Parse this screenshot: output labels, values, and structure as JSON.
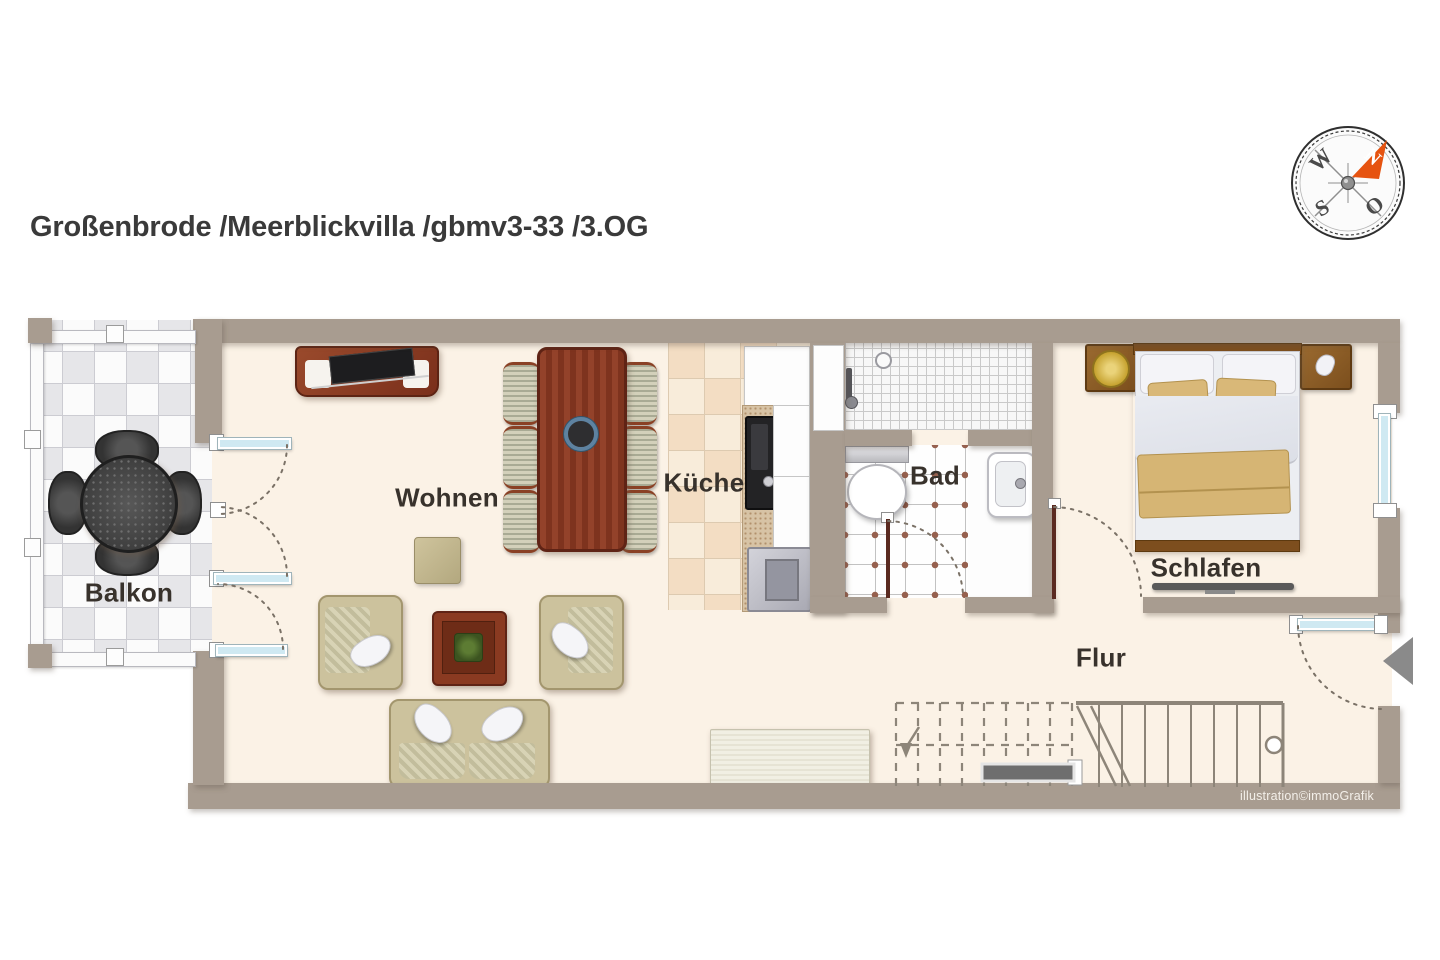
{
  "header": {
    "title": "Großenbrode /Meerblickvilla /gbmv3-33 /3.OG"
  },
  "compass": {
    "north": "N",
    "east": "O",
    "south": "S",
    "west": "W"
  },
  "rooms": {
    "balkon": "Balkon",
    "wohnen": "Wohnen",
    "kueche": "Küche",
    "bad": "Bad",
    "schlafen": "Schlafen",
    "flur": "Flur"
  },
  "credit": "illustration©immoGrafik",
  "colors": {
    "wall": "#a89c90",
    "floor": "#fbf2e6",
    "kitchen_tile": "#f3ddc3",
    "balcony_tile": "#e6e6e9",
    "door_glass": "#cfe9f2",
    "tile_dot": "#96604e",
    "compass_arrow": "#e65310",
    "title_text": "#3a3a3a"
  }
}
